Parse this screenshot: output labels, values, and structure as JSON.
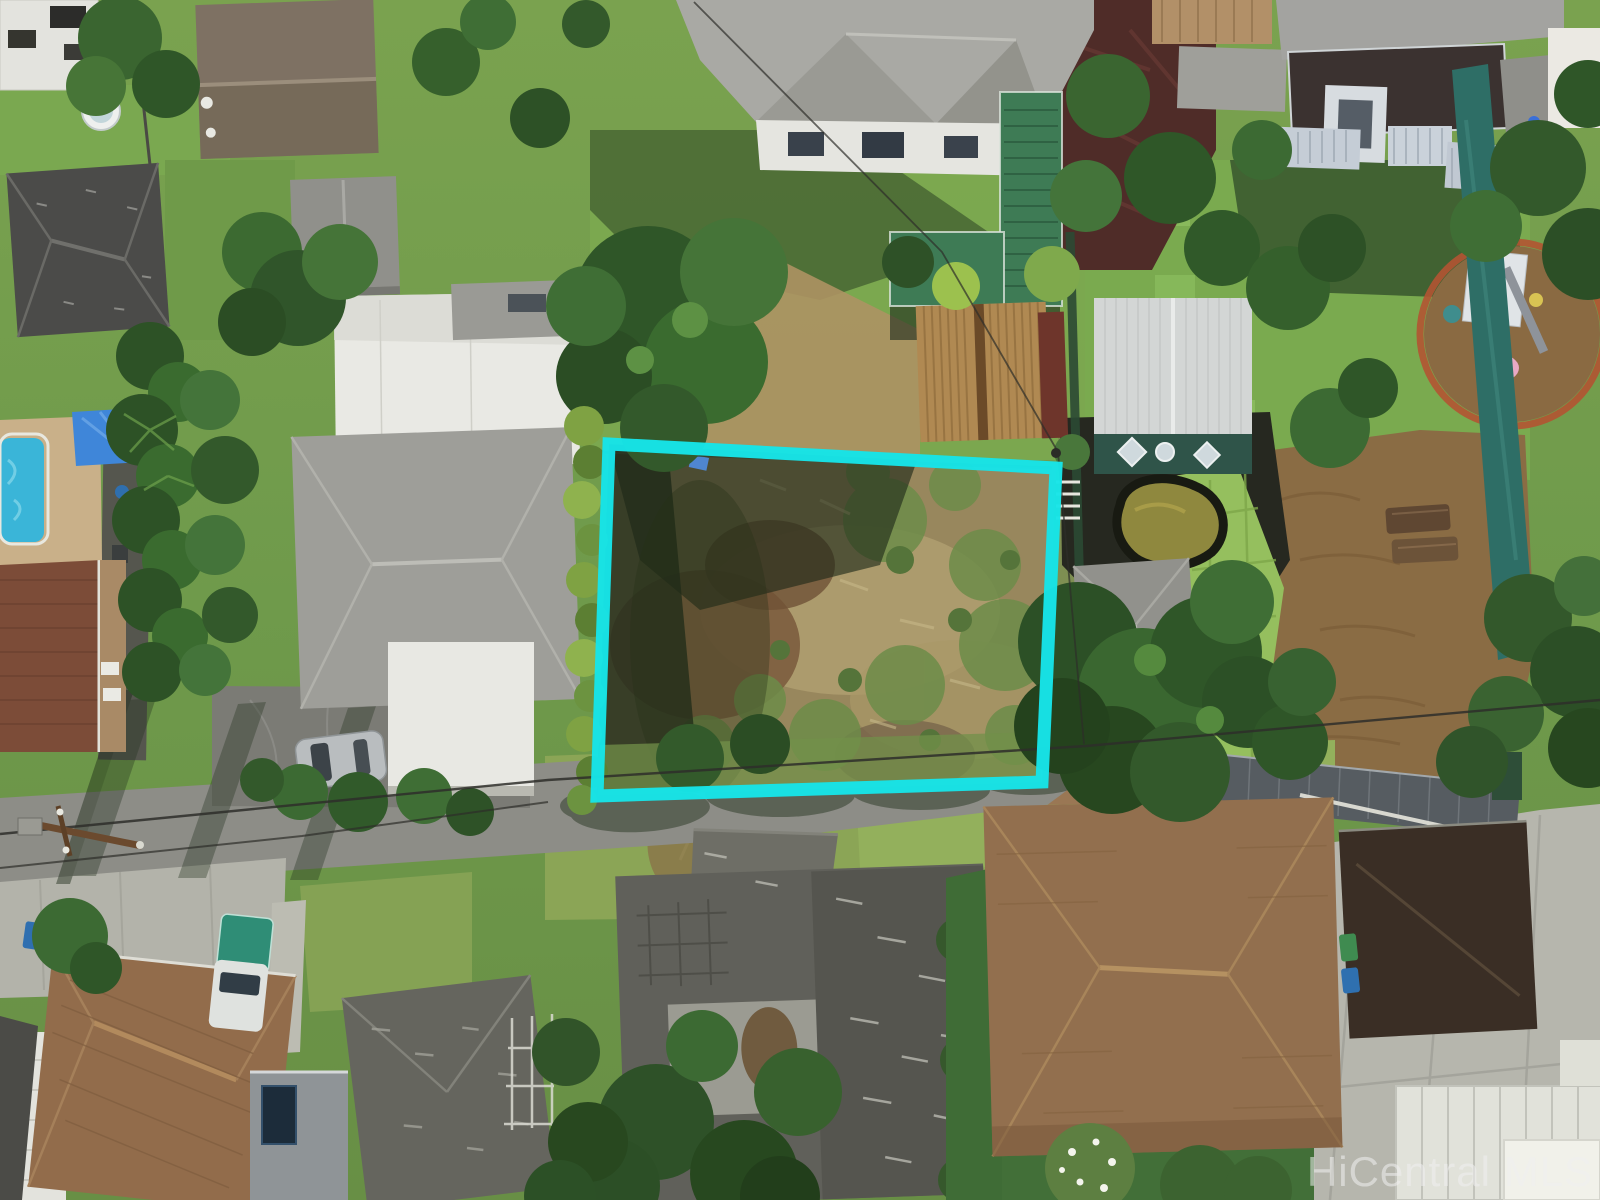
{
  "scene": {
    "type": "aerial-drone-photo",
    "subject": "residential-neighborhood-with-vacant-lot",
    "watermark_text": "HiCentral MLS"
  },
  "boundary_overlay": {
    "points": "609,444 1056,468 1042,782 597,796",
    "color": "#17E4E8",
    "stroke_width": "13"
  },
  "palette": {
    "lawn_base": "#739c4b",
    "lot_soil": "#98875d",
    "road_gray": "#8d8d87",
    "pool_blue": "#3ab5d8",
    "pond_water": "#8f883e",
    "tarp_teal": "#2e6e66",
    "deck_green": "#3e7b55",
    "watermark_fill": "#f0f0f0"
  }
}
